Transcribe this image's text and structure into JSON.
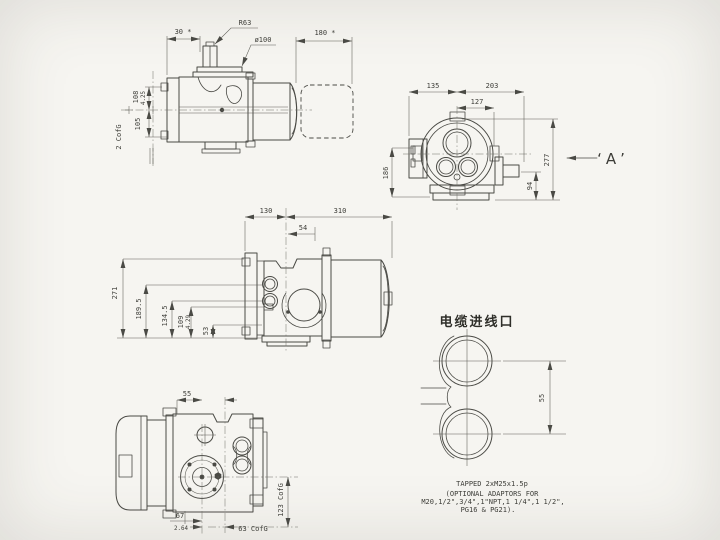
{
  "sheet": {
    "description": "Electric actuator outline dimensional drawing, four orthographic views plus cable entry detail"
  },
  "view_side": {
    "d30": "30 *",
    "r63": "R63",
    "dia100": "ø100",
    "d180": "180 *",
    "d108": "108",
    "d108_in": "4.25",
    "d105": "105",
    "cofg": "2 CofG"
  },
  "view_end": {
    "d135": "135",
    "d203": "203",
    "d127": "127",
    "d186": "186",
    "d94": "94",
    "d277": "277",
    "label_a": "‘A’"
  },
  "view_front": {
    "d130": "130",
    "d310": "310",
    "d54": "54",
    "d271": "271",
    "d189_5": "189.5",
    "d134_5": "134.5",
    "d109": "109",
    "d109_in": "4.29",
    "d53": "53"
  },
  "view_plan": {
    "d55": "55",
    "d123": "123 CofG",
    "d67": "67",
    "d67_in": "2.64",
    "d63": "63 CofG"
  },
  "cable_detail": {
    "title": "电缆进线口",
    "d55": "55",
    "note1": "TAPPED 2xM25x1.5p",
    "note2": "(OPTIONAL ADAPTORS FOR",
    "note3": "M20,1/2\",3/4\",1\"NPT,1 1/4\",1 1/2\",",
    "note4": "PG16 & PG21)."
  },
  "colors": {
    "paper": "#f6f5f1",
    "line": "#4a4a45",
    "text": "#3d3d38"
  }
}
